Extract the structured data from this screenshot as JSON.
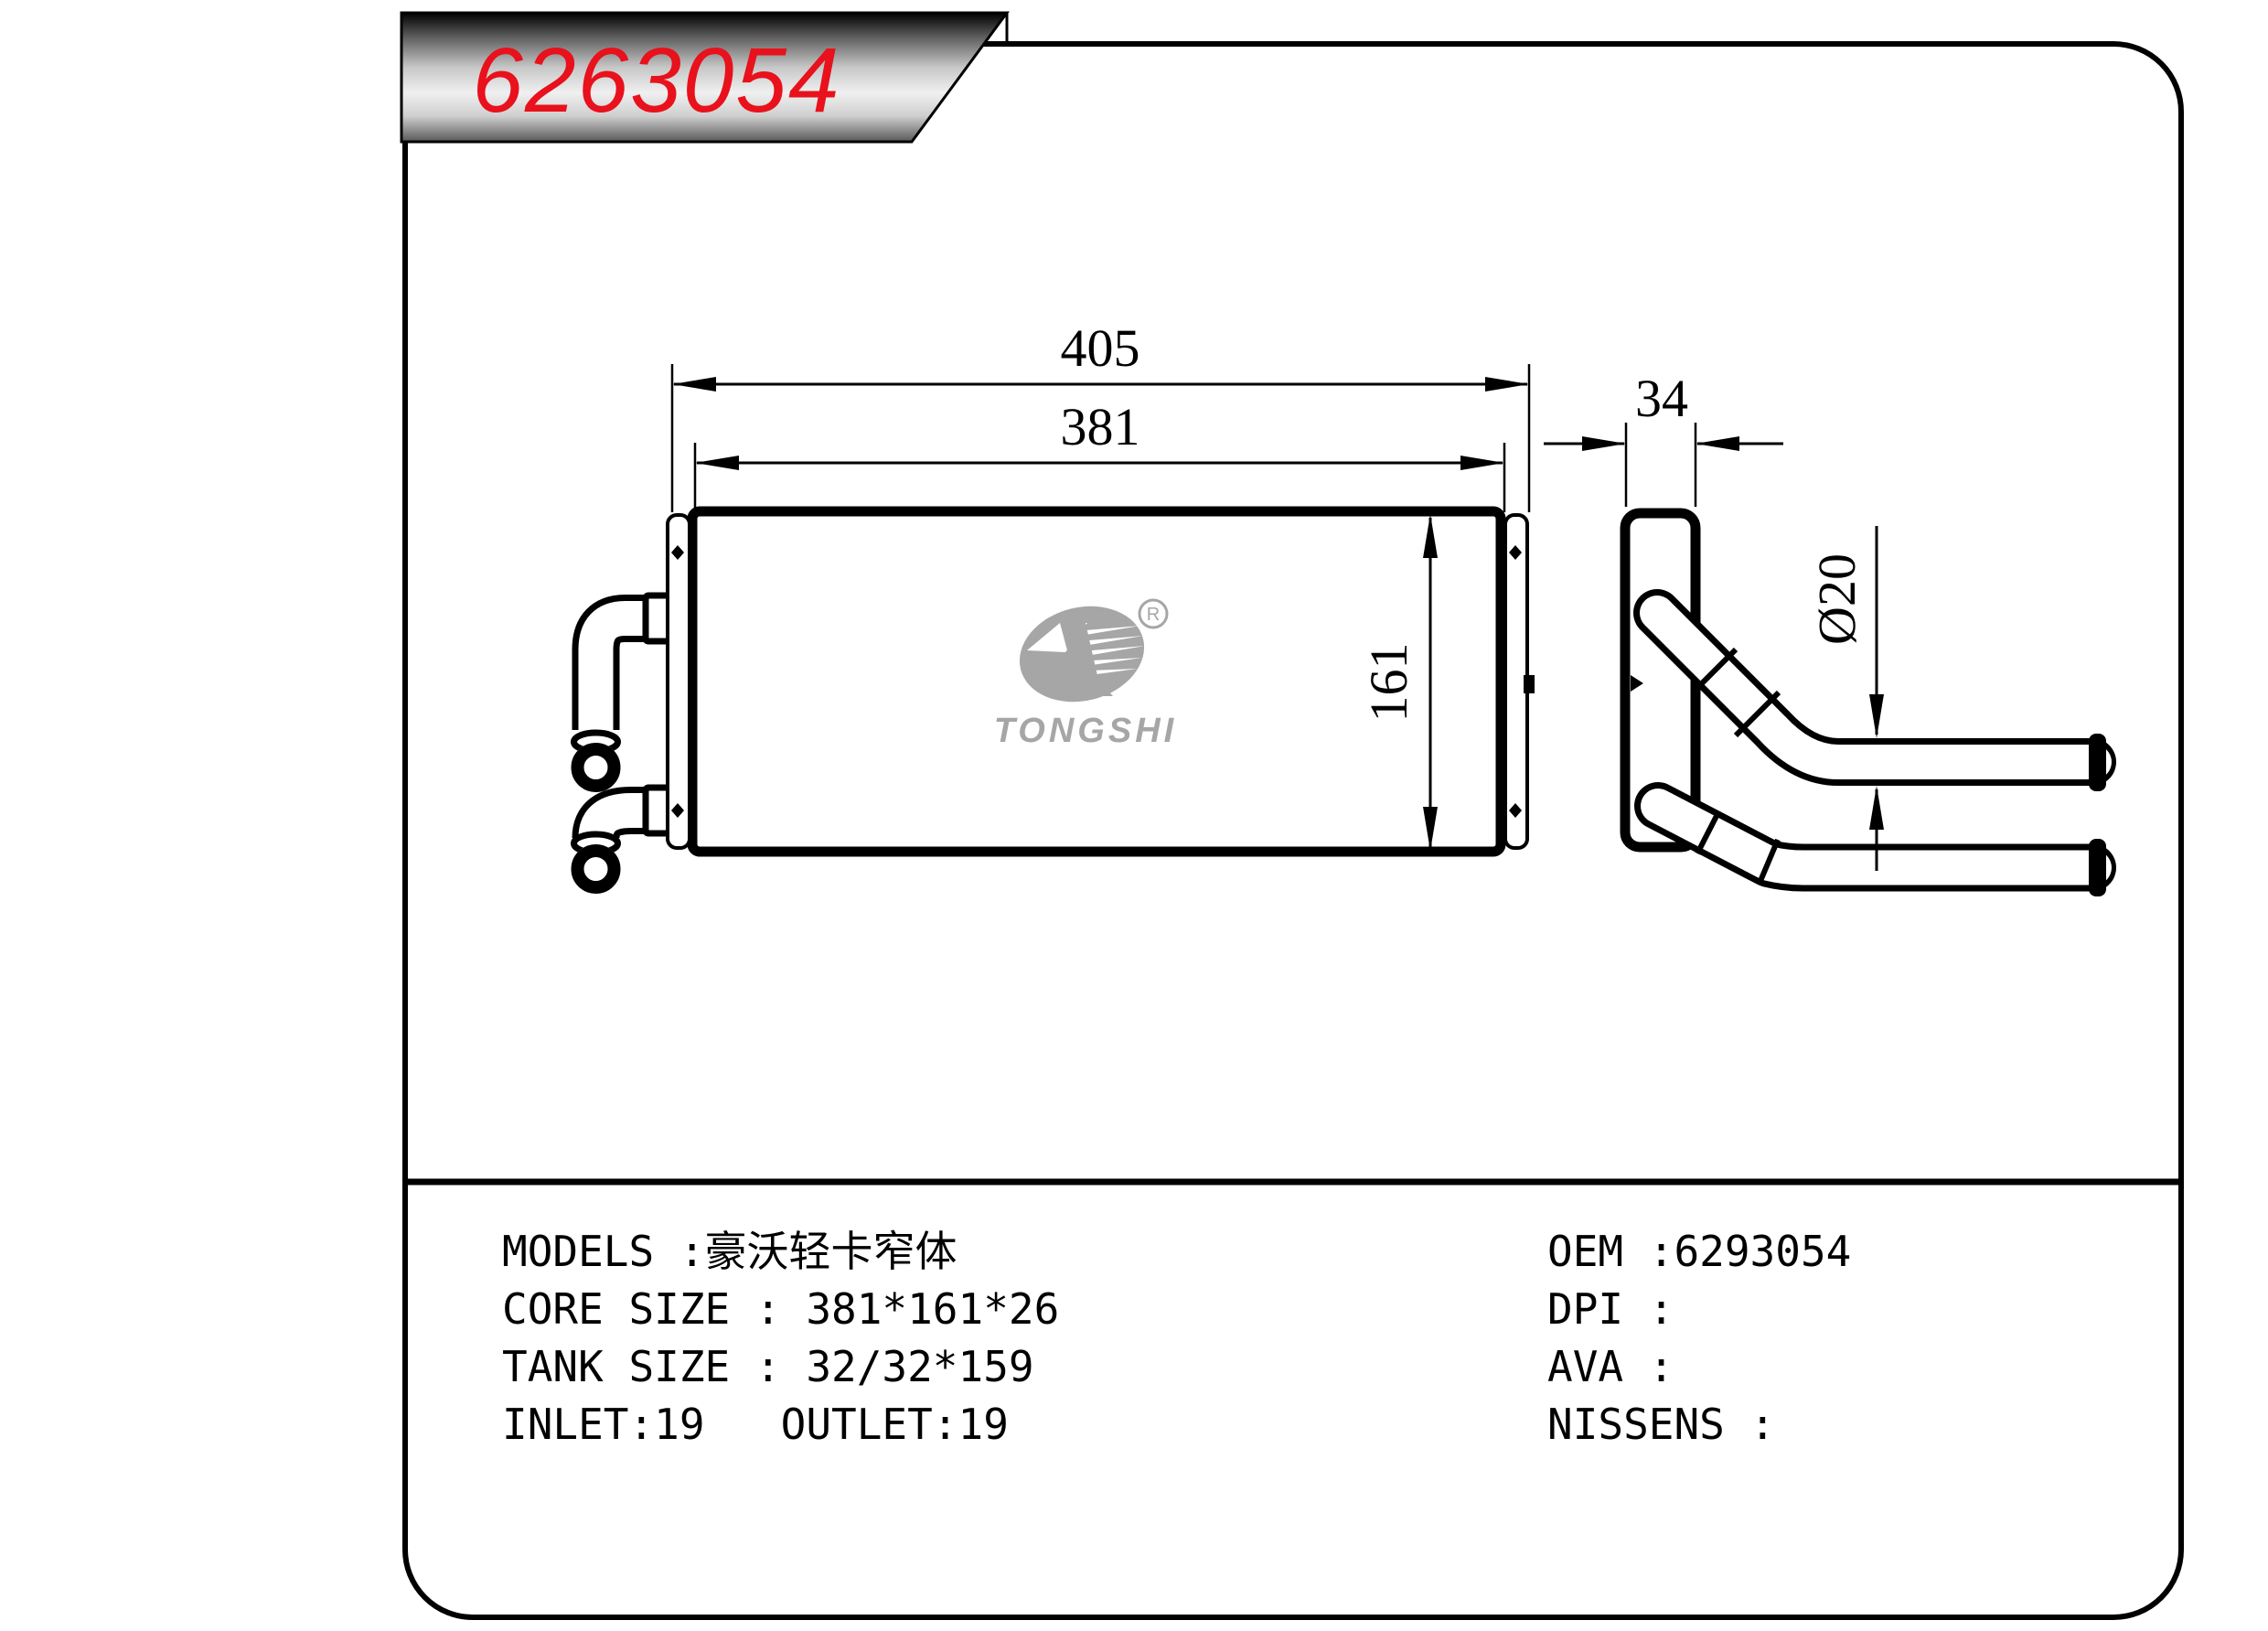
{
  "banner": {
    "part_number": "6263054"
  },
  "colors": {
    "accent_red": "#e8111c",
    "line_black": "#000000",
    "logo_gray": "#a6a6a6"
  },
  "dimensions": {
    "overall_width": "405",
    "core_width": "381",
    "side_depth": "34",
    "core_height": "161",
    "pipe_diameter": "Ø20"
  },
  "logo": {
    "brand": "TONGSHI",
    "registered_mark": "R"
  },
  "specs": {
    "left_lines": [
      "MODELS :豪沃轻卡窄体",
      "CORE SIZE : 381*161*26",
      "TANK SIZE : 32/32*159",
      "INLET:19   OUTLET:19"
    ],
    "right_lines": [
      "OEM :6293054",
      "DPI :",
      "AVA :",
      "NISSENS :"
    ]
  }
}
